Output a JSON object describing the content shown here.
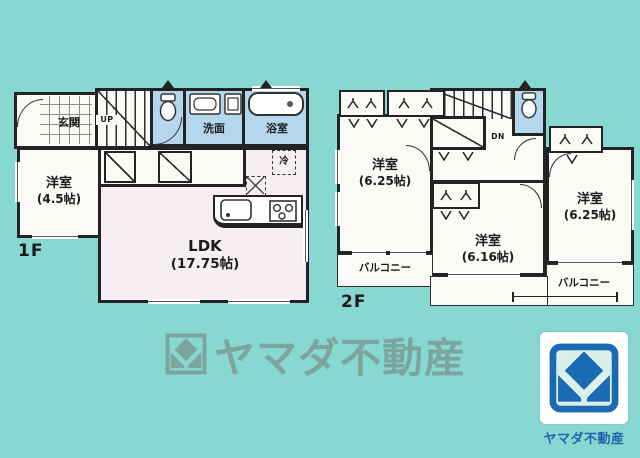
{
  "colors": {
    "background": "#87d8d0",
    "wall": "#232323",
    "wet_room": "#b4d7ee",
    "ldk_pink": "#f7eef4",
    "room_white": "#fbfaf7",
    "watermark": "#7da5a0",
    "logo_blue": "#1a6ab4",
    "logo_caption": "#2163ae"
  },
  "floor1": {
    "label": "1F",
    "genkan": "玄関",
    "stairs": "UP",
    "senmen": "洗面",
    "bath": "浴室",
    "fridge": "冷",
    "bedroom": {
      "name": "洋室",
      "size": "(4.5帖)"
    },
    "ldk": {
      "name": "LDK",
      "size": "(17.75帖)"
    }
  },
  "floor2": {
    "label": "2F",
    "stairs": "DN",
    "bedroom_northwest": {
      "name": "洋室",
      "size": "(6.25帖)"
    },
    "bedroom_center": {
      "name": "洋室",
      "size": "(6.16帖)"
    },
    "bedroom_east": {
      "name": "洋室",
      "size": "(6.25帖)"
    },
    "balcony_left": "バルコニー",
    "balcony_right": "バルコニー"
  },
  "watermark": {
    "text": "ヤマダ不動産"
  },
  "logo": {
    "caption": "ヤマダ不動産"
  }
}
